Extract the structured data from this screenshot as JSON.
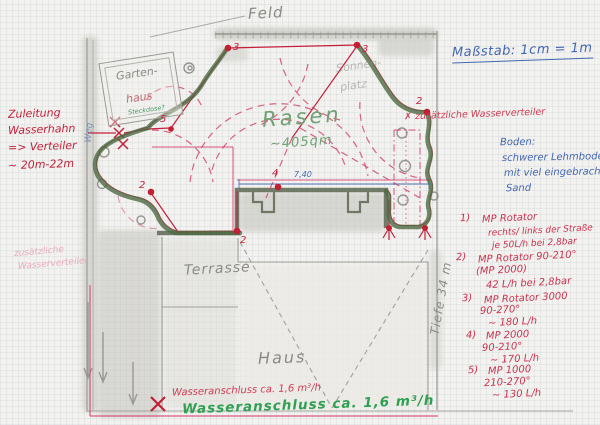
{
  "colors": {
    "red_pen": "#c5203a",
    "crimson_list": "#cc3350",
    "pink_line": "#d84070",
    "blue_pen": "#4366b2",
    "green_marker": "#4c6a43",
    "green_text": "#6fa173",
    "green_bold": "#2fa052",
    "pencil": "#8b8b85"
  },
  "plan": {
    "feld_label": "Feld",
    "rasen_label": "Rasen",
    "rasen_area": "~405qm",
    "sonnenplatz_line1": "Sonnen-",
    "sonnenplatz_line2": "platz",
    "terrasse_label": "Terrasse",
    "haus_label": "Haus",
    "gartenhaus_line1": "Garten-",
    "gartenhaus_line2": "haus",
    "steckdose_note": "Steckdose?",
    "weg_note": "Weg",
    "dim_740": "7,40",
    "tiefe_note": "Tiefe 34 m"
  },
  "scale_note": "Maßstab: 1cm = 1m",
  "left_notes": {
    "zuleitung": [
      "Zuleitung",
      "Wasserhahn",
      "=> Verteiler",
      "~ 20m-22m"
    ],
    "zusatz_faint": [
      "zusätzliche",
      "Wasserverteiler"
    ]
  },
  "right_notes": {
    "extra_red": "✗ zusätzliche Wasserverteiler",
    "boden": [
      "Boden:",
      "schwerer Lehmboden",
      "mit viel eingebrachtem",
      "Sand"
    ],
    "sprinkler_list": [
      {
        "num": "1)",
        "lines": [
          "MP Rotator",
          "rechts/ links der Straße",
          "je 50L/h  bei 2,8bar"
        ]
      },
      {
        "num": "2)",
        "lines": [
          "MP Rotator 90-210°",
          "(MP 2000)",
          "42 L/h   bei 2,8bar"
        ]
      },
      {
        "num": "3)",
        "lines": [
          "MP Rotator 3000",
          "90-270°",
          "~ 180 L/h"
        ]
      },
      {
        "num": "4)",
        "lines": [
          "MP 2000",
          "90-210°",
          "~ 170 L/h"
        ]
      },
      {
        "num": "5)",
        "lines": [
          "MP 1000",
          "210-270°",
          "~ 130 L/h"
        ]
      }
    ]
  },
  "bottom_notes": {
    "red": "Wasseranschluss ca. 1,6 m³/h",
    "green": "Wasseranschluss ca. 1,6 m³/h"
  },
  "markers": {
    "p3a": "3",
    "p3b": "3",
    "p2r": "2",
    "p2l": "2",
    "p2t": "2",
    "p4": "4",
    "p5": "5"
  }
}
